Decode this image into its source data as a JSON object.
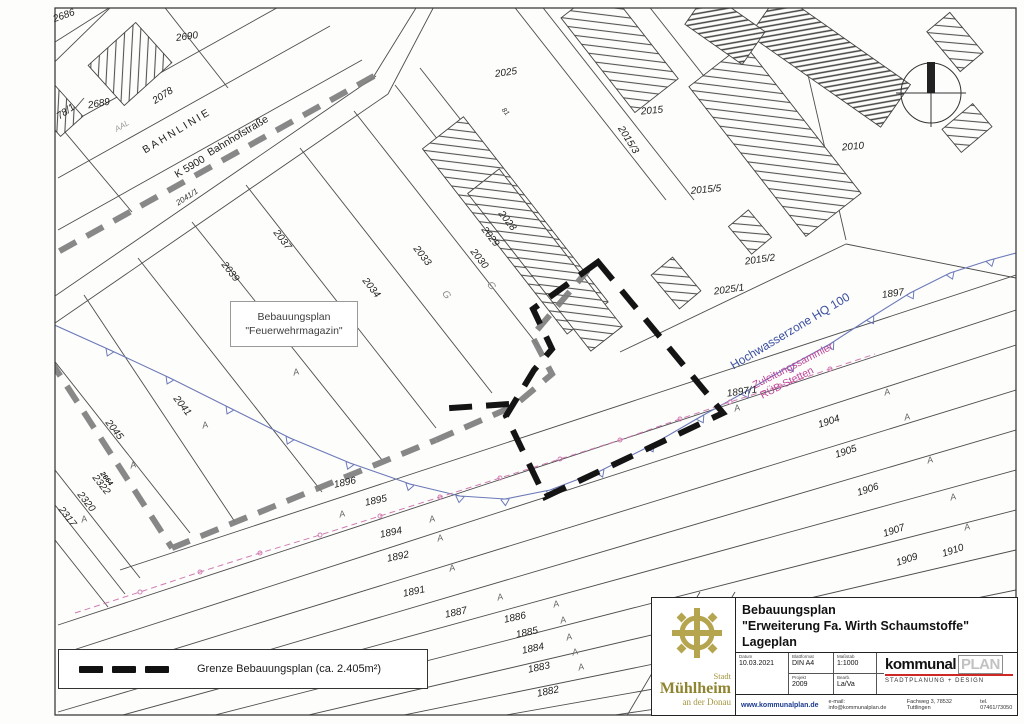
{
  "map": {
    "labels": [
      {
        "t": "2686",
        "x": 64,
        "y": 16,
        "r": -20,
        "c": "p"
      },
      {
        "t": "2690",
        "x": 187,
        "y": 37,
        "r": -8,
        "c": "p"
      },
      {
        "t": "2689",
        "x": 99,
        "y": 104,
        "r": -10,
        "c": "p"
      },
      {
        "t": "78/1",
        "x": 66,
        "y": 112,
        "r": -35,
        "c": "p"
      },
      {
        "t": "2078",
        "x": 163,
        "y": 96,
        "r": -33,
        "c": "p"
      },
      {
        "t": "2041/1",
        "x": 187,
        "y": 197,
        "r": -33,
        "c": "p2s"
      },
      {
        "t": "BAHNLINIE",
        "x": 177,
        "y": 131,
        "r": -31,
        "c": "bahn"
      },
      {
        "t": "K 5900",
        "x": 190,
        "y": 167,
        "r": -31,
        "c": "st"
      },
      {
        "t": "Bahnhofstraße",
        "x": 238,
        "y": 136,
        "r": -31,
        "c": "st"
      },
      {
        "t": "AAL",
        "x": 122,
        "y": 126,
        "r": -31,
        "c": "gray8"
      },
      {
        "t": "2039",
        "x": 230,
        "y": 272,
        "r": 52,
        "c": "p"
      },
      {
        "t": "2037",
        "x": 282,
        "y": 240,
        "r": 52,
        "c": "p"
      },
      {
        "t": "2034",
        "x": 371,
        "y": 288,
        "r": 52,
        "c": "p"
      },
      {
        "t": "2033",
        "x": 422,
        "y": 256,
        "r": 52,
        "c": "p"
      },
      {
        "t": "2030",
        "x": 479,
        "y": 259,
        "r": 52,
        "c": "p"
      },
      {
        "t": "2029",
        "x": 490,
        "y": 237,
        "r": 52,
        "c": "p"
      },
      {
        "t": "2028",
        "x": 507,
        "y": 221,
        "r": 52,
        "c": "p"
      },
      {
        "t": "81",
        "x": 505,
        "y": 112,
        "r": 52,
        "c": "p2"
      },
      {
        "t": "2025",
        "x": 506,
        "y": 73,
        "r": -8,
        "c": "p"
      },
      {
        "t": "2015",
        "x": 652,
        "y": 111,
        "r": -5,
        "c": "p"
      },
      {
        "t": "2015/3",
        "x": 628,
        "y": 140,
        "r": 58,
        "c": "p"
      },
      {
        "t": "2015/5",
        "x": 706,
        "y": 190,
        "r": -5,
        "c": "p"
      },
      {
        "t": "2015/2",
        "x": 760,
        "y": 260,
        "r": -8,
        "c": "p"
      },
      {
        "t": "2025/1",
        "x": 729,
        "y": 290,
        "r": -8,
        "c": "p"
      },
      {
        "t": "2010",
        "x": 853,
        "y": 147,
        "r": -5,
        "c": "p"
      },
      {
        "t": "1897",
        "x": 893,
        "y": 294,
        "r": -8,
        "c": "p"
      },
      {
        "t": "1897/1",
        "x": 742,
        "y": 392,
        "r": -8,
        "c": "p"
      },
      {
        "t": "2045",
        "x": 114,
        "y": 430,
        "r": 52,
        "c": "p"
      },
      {
        "t": "2041",
        "x": 182,
        "y": 406,
        "r": 52,
        "c": "p"
      },
      {
        "t": "2322",
        "x": 101,
        "y": 485,
        "r": 52,
        "c": "p"
      },
      {
        "t": "2320",
        "x": 86,
        "y": 502,
        "r": 52,
        "c": "p"
      },
      {
        "t": "2317",
        "x": 67,
        "y": 517,
        "r": 52,
        "c": "p"
      },
      {
        "t": "2664",
        "x": 106,
        "y": 479,
        "r": 52,
        "c": "p2b"
      },
      {
        "t": "1896",
        "x": 345,
        "y": 483,
        "r": -12,
        "c": "p"
      },
      {
        "t": "1895",
        "x": 376,
        "y": 501,
        "r": -12,
        "c": "p"
      },
      {
        "t": "1894",
        "x": 391,
        "y": 533,
        "r": -12,
        "c": "p"
      },
      {
        "t": "1892",
        "x": 398,
        "y": 557,
        "r": -12,
        "c": "p"
      },
      {
        "t": "1891",
        "x": 414,
        "y": 592,
        "r": -12,
        "c": "p"
      },
      {
        "t": "1887",
        "x": 456,
        "y": 613,
        "r": -12,
        "c": "p"
      },
      {
        "t": "1886",
        "x": 515,
        "y": 618,
        "r": -12,
        "c": "p"
      },
      {
        "t": "1885",
        "x": 527,
        "y": 633,
        "r": -12,
        "c": "p"
      },
      {
        "t": "1884",
        "x": 533,
        "y": 649,
        "r": -12,
        "c": "p"
      },
      {
        "t": "1883",
        "x": 539,
        "y": 668,
        "r": -12,
        "c": "p"
      },
      {
        "t": "1882",
        "x": 548,
        "y": 692,
        "r": -12,
        "c": "p"
      },
      {
        "t": "1904",
        "x": 829,
        "y": 422,
        "r": -18,
        "c": "p"
      },
      {
        "t": "1905",
        "x": 846,
        "y": 452,
        "r": -18,
        "c": "p"
      },
      {
        "t": "1906",
        "x": 868,
        "y": 490,
        "r": -18,
        "c": "p"
      },
      {
        "t": "1907",
        "x": 894,
        "y": 531,
        "r": -18,
        "c": "p"
      },
      {
        "t": "1909",
        "x": 907,
        "y": 560,
        "r": -18,
        "c": "p"
      },
      {
        "t": "1910",
        "x": 953,
        "y": 551,
        "r": -18,
        "c": "p"
      },
      {
        "t": "Hochwasserzone HQ 100",
        "x": 790,
        "y": 331,
        "r": -31,
        "c": "blue"
      },
      {
        "t": "Zuleitungssammler",
        "x": 793,
        "y": 366,
        "r": -27,
        "c": "mag"
      },
      {
        "t": "RÜB Stetten",
        "x": 787,
        "y": 383,
        "r": -27,
        "c": "mag"
      },
      {
        "t": "A",
        "x": 296,
        "y": 372,
        "r": -15,
        "c": "mark"
      },
      {
        "t": "A",
        "x": 205,
        "y": 425,
        "r": -15,
        "c": "mark"
      },
      {
        "t": "A",
        "x": 133,
        "y": 465,
        "r": -15,
        "c": "mark"
      },
      {
        "t": "A",
        "x": 84,
        "y": 519,
        "r": -15,
        "c": "mark"
      },
      {
        "t": "A",
        "x": 342,
        "y": 514,
        "r": -15,
        "c": "mark"
      },
      {
        "t": "A",
        "x": 432,
        "y": 519,
        "r": -15,
        "c": "mark"
      },
      {
        "t": "A",
        "x": 440,
        "y": 538,
        "r": -15,
        "c": "mark"
      },
      {
        "t": "A",
        "x": 452,
        "y": 568,
        "r": -15,
        "c": "mark"
      },
      {
        "t": "A",
        "x": 500,
        "y": 597,
        "r": -15,
        "c": "mark"
      },
      {
        "t": "A",
        "x": 556,
        "y": 604,
        "r": -15,
        "c": "mark"
      },
      {
        "t": "A",
        "x": 563,
        "y": 620,
        "r": -15,
        "c": "mark"
      },
      {
        "t": "A",
        "x": 569,
        "y": 637,
        "r": -15,
        "c": "mark"
      },
      {
        "t": "A",
        "x": 575,
        "y": 652,
        "r": -15,
        "c": "mark"
      },
      {
        "t": "A",
        "x": 581,
        "y": 667,
        "r": -15,
        "c": "mark"
      },
      {
        "t": "A",
        "x": 737,
        "y": 408,
        "r": -15,
        "c": "mark"
      },
      {
        "t": "A",
        "x": 887,
        "y": 392,
        "r": -15,
        "c": "mark"
      },
      {
        "t": "A",
        "x": 907,
        "y": 417,
        "r": -15,
        "c": "mark"
      },
      {
        "t": "A",
        "x": 930,
        "y": 460,
        "r": -15,
        "c": "mark"
      },
      {
        "t": "A",
        "x": 953,
        "y": 497,
        "r": -15,
        "c": "mark"
      },
      {
        "t": "A",
        "x": 967,
        "y": 527,
        "r": -15,
        "c": "mark"
      },
      {
        "t": "G",
        "x": 446,
        "y": 295,
        "r": 52,
        "c": "g"
      },
      {
        "t": "G",
        "x": 491,
        "y": 286,
        "r": 52,
        "c": "g"
      }
    ],
    "info_box": {
      "line1": "Bebauungsplan",
      "line2": "\"Feuerwehrmagazin\""
    },
    "colors": {
      "boundary_black": "#141414",
      "boundary_gray": "#7e7e7e",
      "flood_blue": "#6b79b8",
      "flood_text_blue": "#3b4fa0",
      "sewer_magenta": "#d17ab0",
      "sewer_text_magenta": "#c0459a"
    }
  },
  "legend": {
    "label": "Grenze Bebauungsplan (ca. 2.405m²)"
  },
  "title_block": {
    "title_line1": "Bebauungsplan",
    "title_line2": "\"Erweiterung Fa. Wirth Schaumstoffe\"",
    "title_line3": "Lageplan",
    "fields": [
      {
        "label": "Datum",
        "value": "10.03.2021"
      },
      {
        "label": "Blattformat",
        "value": "DIN A4"
      },
      {
        "label": "Maßstab",
        "value": "1:1000"
      },
      {
        "label": "Projekt",
        "value": "2009"
      },
      {
        "label": "Bearb.",
        "value": "La/Va"
      }
    ],
    "logo_city": {
      "small_top": "Stadt",
      "name": "Mühlheim",
      "small_bottom": "an der Donau"
    },
    "logo_firm": {
      "part1": "kommunal",
      "part2": "PLAN",
      "subtitle": "STADTPLANUNG + DESIGN"
    },
    "footer": {
      "web": "www.kommunalplan.de",
      "email": "e-mail: info@kommunalplan.de",
      "address": "Fachweg 3, 78532 Tuttlingen",
      "phone": "tel. 07461/73050"
    }
  }
}
